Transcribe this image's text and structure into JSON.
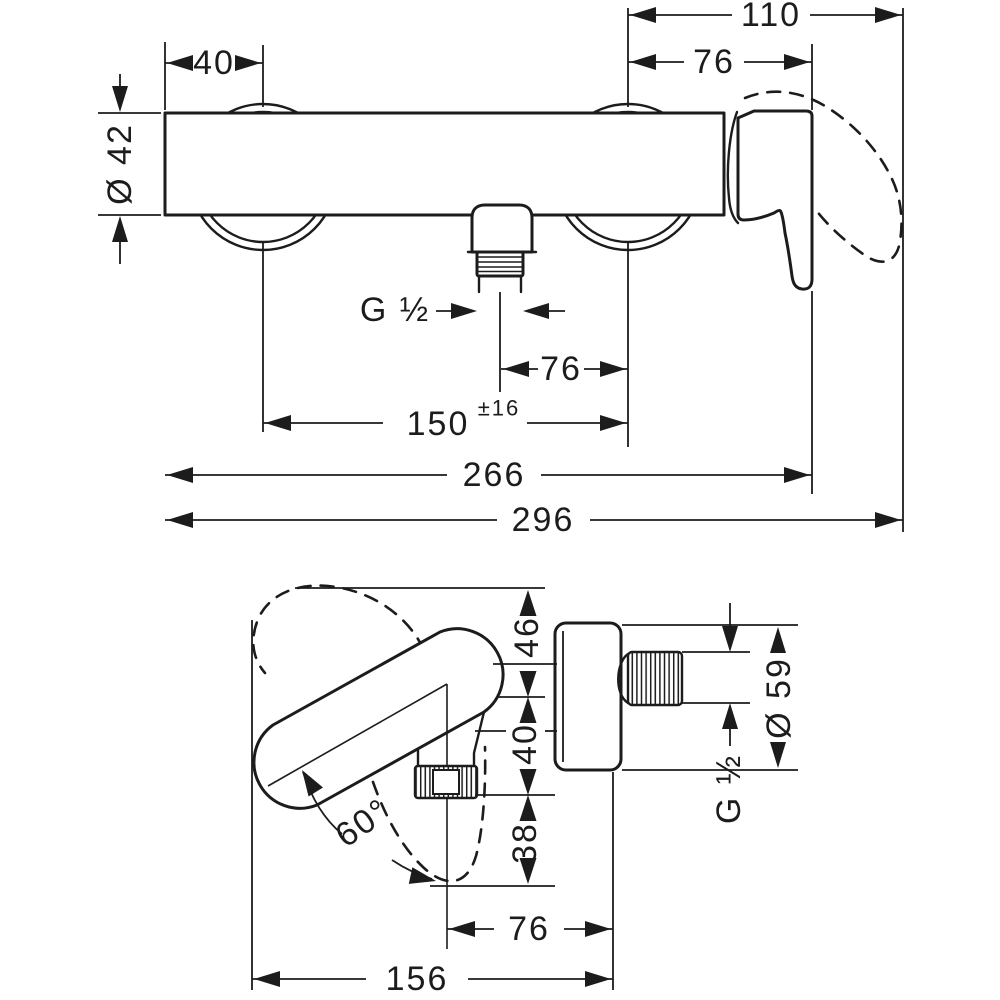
{
  "colors": {
    "ink": "#1c1c1c",
    "paper": "#ffffff"
  },
  "front_view": {
    "dim_110": "110",
    "dim_76_top": "76",
    "dim_40": "40",
    "dim_dia_42": "Ø 42",
    "thread_label": "G ½",
    "dim_76_outlet": "76",
    "dim_150": "150",
    "dim_150_tol": "±16",
    "dim_266": "266",
    "dim_296": "296"
  },
  "side_view": {
    "dim_46": "46",
    "dim_40": "40",
    "dim_38": "38",
    "dim_dia_59": "Ø 59",
    "thread_label": "G ½",
    "dim_angle": "60°",
    "dim_76": "76",
    "dim_156": "156"
  }
}
